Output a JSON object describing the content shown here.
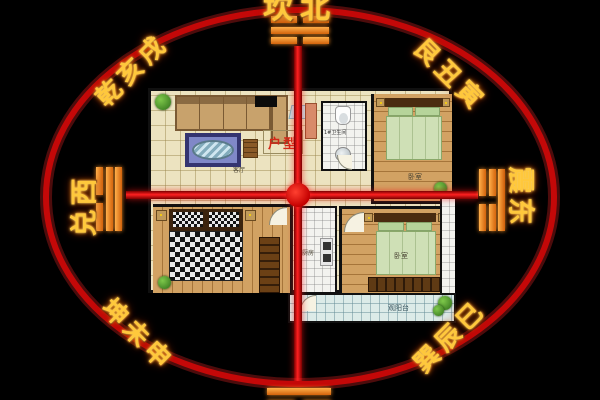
{
  "compass": {
    "north": {
      "label": "坎北",
      "trigram": "kan"
    },
    "south": {
      "trigram": "li"
    },
    "west": {
      "label": "兑西",
      "trigram": "dui"
    },
    "east": {
      "label": "震东",
      "trigram": "zhen"
    },
    "northwest": {
      "label": "乾亥戌"
    },
    "northeast": {
      "label": "艮丑寅"
    },
    "southwest": {
      "label": "坤未申"
    },
    "southeast": {
      "label": "巽辰巳"
    },
    "colors": {
      "circle": "#c40808",
      "cross": "#e81212",
      "text_gold": "#ffc83c",
      "trigram_orange": "#e0761a"
    }
  },
  "floor_plan": {
    "title": "户型",
    "room_labels": {
      "living_room": "客厅",
      "bathroom": "1#卫生间",
      "bedroom_top": "卧室",
      "bedroom_bottom": "卧室",
      "kitchen": "厨房",
      "balcony": "观阳台"
    }
  }
}
